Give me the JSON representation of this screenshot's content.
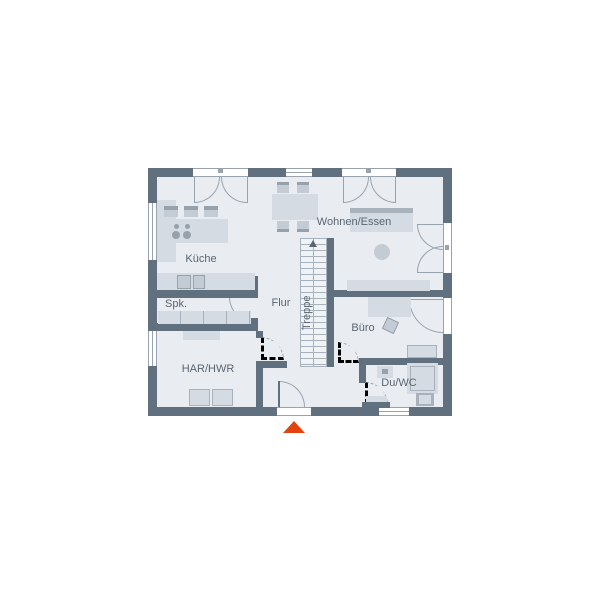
{
  "colors": {
    "wall": "#60707f",
    "interior": "#e9edf2",
    "line": "#98a3ae",
    "furn": "#d4dbe2",
    "furn_mid": "#c3ccd4",
    "furn_dark": "#a8b2bc",
    "appliance": "#96a1ac",
    "label": "#5a6572",
    "accent": "#e2430f",
    "stairbg": "#f0f3f6",
    "paper": "#ffffff"
  },
  "rooms": {
    "kueche": {
      "label": "Küche"
    },
    "spk": {
      "label": "Spk."
    },
    "flur": {
      "label": "Flur"
    },
    "treppe": {
      "label": "Treppe"
    },
    "wohnen": {
      "label": "Wohnen/Essen"
    },
    "buero": {
      "label": "Büro"
    },
    "har_hwr": {
      "label": "HAR/HWR"
    },
    "du_wc": {
      "label": "Du/WC"
    }
  }
}
